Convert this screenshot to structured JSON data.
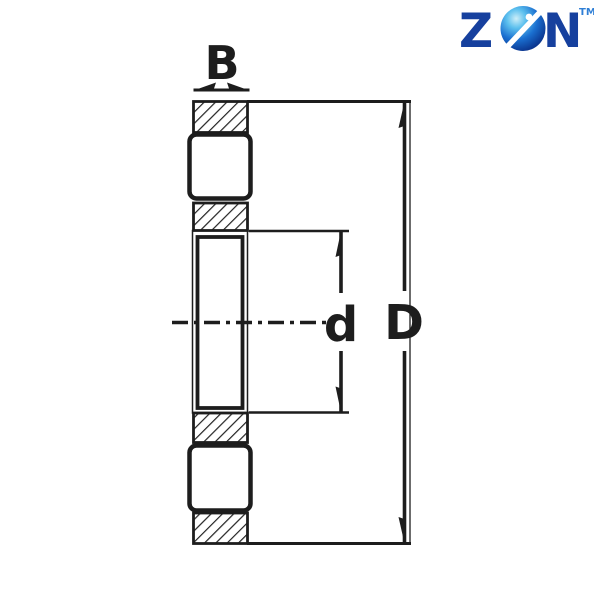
{
  "logo": {
    "letter_start": "Z",
    "letter_end": "N",
    "trademark": "TM",
    "brand_color": "#16409e",
    "trademark_color": "#2f7fd6",
    "globe_highlight": "#cdeef8",
    "globe_mid": "#1a6fd0",
    "globe_dark": "#082a7a"
  },
  "diagram": {
    "description": "Bearing cross-section technical drawing with dimension callouts",
    "line_color": "#1d1d1d",
    "background": "#ffffff",
    "labels": {
      "width_label": "B",
      "bore_diameter_label": "d",
      "outer_diameter_label": "D"
    }
  }
}
